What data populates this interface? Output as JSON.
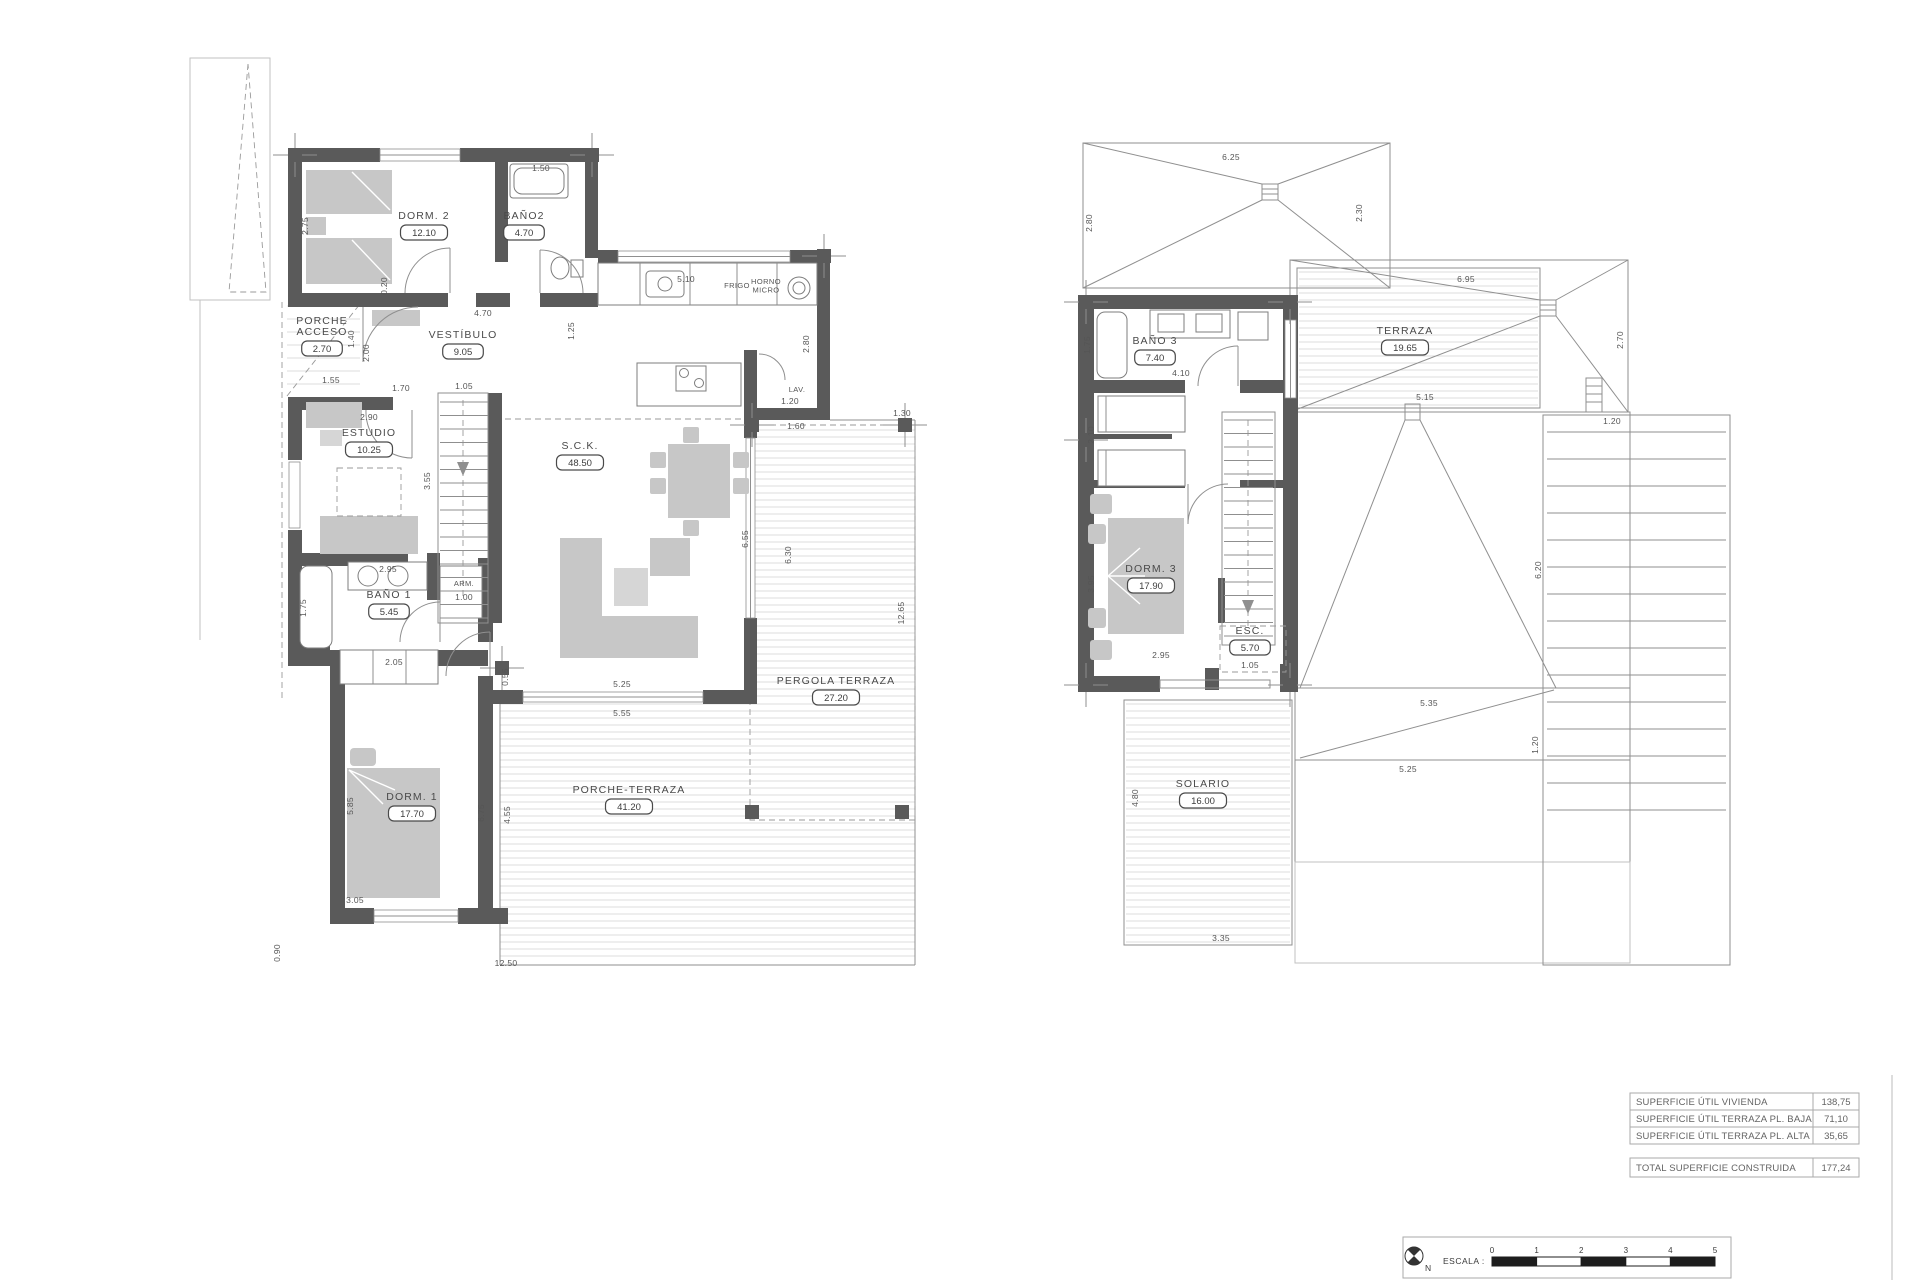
{
  "document": {
    "type": "architectural floor plan, two storeys"
  },
  "colors": {
    "wall": "#5a5a5a",
    "furniture": "#c7c7c7",
    "hatch": "#d2d2d2",
    "label": "#4a4a4a"
  },
  "ground_floor": {
    "rooms": [
      {
        "name": "DORM. 2",
        "area": "12.10",
        "x": 424,
        "y": 219
      },
      {
        "name": "BAÑO2",
        "area": "4.70",
        "x": 524,
        "y": 219
      },
      {
        "name": "PORCHE\nACCESO",
        "area": "2.70",
        "x": 322,
        "y": 324
      },
      {
        "name": "VESTÍBULO",
        "area": "9.05",
        "x": 463,
        "y": 338
      },
      {
        "name": "ESTUDIO",
        "area": "10.25",
        "x": 369,
        "y": 436
      },
      {
        "name": "S.C.K.",
        "area": "48.50",
        "x": 580,
        "y": 449
      },
      {
        "name": "BAÑO 1",
        "area": "5.45",
        "x": 389,
        "y": 598
      },
      {
        "name": "DORM. 1",
        "area": "17.70",
        "x": 412,
        "y": 800
      },
      {
        "name": "PERGOLA TERRAZA",
        "area": "27.20",
        "x": 836,
        "y": 684
      },
      {
        "name": "PORCHE-TERRAZA",
        "area": "41.20",
        "x": 629,
        "y": 793
      }
    ],
    "annotations": [
      {
        "text": "FRIGO",
        "x": 737,
        "y": 288
      },
      {
        "text": "HORNO\nMICRO",
        "x": 766,
        "y": 284
      },
      {
        "text": "LAV.",
        "x": 797,
        "y": 392
      },
      {
        "text": "ARM.",
        "x": 464,
        "y": 586
      }
    ],
    "dims": [
      {
        "t": "1.50",
        "x": 541,
        "y": 171,
        "r": 0
      },
      {
        "t": "2.75",
        "x": 308,
        "y": 226,
        "r": 90
      },
      {
        "t": "0.20",
        "x": 387,
        "y": 286,
        "r": 90
      },
      {
        "t": "4.70",
        "x": 483,
        "y": 316,
        "r": 0
      },
      {
        "t": "5.10",
        "x": 686,
        "y": 282,
        "r": 0
      },
      {
        "t": "1.25",
        "x": 574,
        "y": 331,
        "r": 90
      },
      {
        "t": "2.80",
        "x": 809,
        "y": 344,
        "r": 90
      },
      {
        "t": "1.20",
        "x": 790,
        "y": 404,
        "r": 0
      },
      {
        "t": "1.60",
        "x": 796,
        "y": 429,
        "r": 0
      },
      {
        "t": "1.30",
        "x": 902,
        "y": 416,
        "r": 0
      },
      {
        "t": "1.55",
        "x": 331,
        "y": 383,
        "r": 0
      },
      {
        "t": "1.70",
        "x": 401,
        "y": 391,
        "r": 0
      },
      {
        "t": "2.00",
        "x": 369,
        "y": 353,
        "r": 90
      },
      {
        "t": "1.40",
        "x": 354,
        "y": 339,
        "r": 90
      },
      {
        "t": "2.90",
        "x": 369,
        "y": 420,
        "r": 0
      },
      {
        "t": "1.05",
        "x": 464,
        "y": 389,
        "r": 0
      },
      {
        "t": "3.55",
        "x": 430,
        "y": 481,
        "r": 90
      },
      {
        "t": "2.95",
        "x": 388,
        "y": 572,
        "r": 0
      },
      {
        "t": "1.00",
        "x": 464,
        "y": 600,
        "r": 0
      },
      {
        "t": "1.75",
        "x": 306,
        "y": 608,
        "r": 90
      },
      {
        "t": "2.05",
        "x": 394,
        "y": 665,
        "r": 0
      },
      {
        "t": "0.55",
        "x": 508,
        "y": 677,
        "r": 90
      },
      {
        "t": "5.25",
        "x": 622,
        "y": 687,
        "r": 0
      },
      {
        "t": "5.55",
        "x": 622,
        "y": 716,
        "r": 0
      },
      {
        "t": "5.85",
        "x": 353,
        "y": 806,
        "r": 90
      },
      {
        "t": "6.75",
        "x": 484,
        "y": 813,
        "r": 90
      },
      {
        "t": "4.55",
        "x": 510,
        "y": 815,
        "r": 90
      },
      {
        "t": "3.05",
        "x": 355,
        "y": 903,
        "r": 0
      },
      {
        "t": "0.90",
        "x": 280,
        "y": 953,
        "r": 90
      },
      {
        "t": "12.50",
        "x": 506,
        "y": 966,
        "r": 0
      },
      {
        "t": "12.65",
        "x": 904,
        "y": 613,
        "r": 90
      },
      {
        "t": "6.55",
        "x": 748,
        "y": 539,
        "r": 90
      },
      {
        "t": "6.30",
        "x": 791,
        "y": 555,
        "r": 90
      }
    ]
  },
  "upper_floor": {
    "rooms": [
      {
        "name": "BAÑO 3",
        "area": "7.40",
        "x": 1155,
        "y": 344
      },
      {
        "name": "TERRAZA",
        "area": "19.65",
        "x": 1405,
        "y": 334
      },
      {
        "name": "DORM. 3",
        "area": "17.90",
        "x": 1151,
        "y": 572
      },
      {
        "name": "ESC.",
        "area": "5.70",
        "x": 1250,
        "y": 634
      },
      {
        "name": "SOLARIO",
        "area": "16.00",
        "x": 1203,
        "y": 787
      }
    ],
    "dims": [
      {
        "t": "6.25",
        "x": 1231,
        "y": 160,
        "r": 0
      },
      {
        "t": "2.80",
        "x": 1092,
        "y": 223,
        "r": 90
      },
      {
        "t": "2.30",
        "x": 1362,
        "y": 213,
        "r": 90
      },
      {
        "t": "6.95",
        "x": 1466,
        "y": 282,
        "r": 0
      },
      {
        "t": "2.70",
        "x": 1623,
        "y": 340,
        "r": 90
      },
      {
        "t": "1.20",
        "x": 1612,
        "y": 424,
        "r": 0
      },
      {
        "t": "5.15",
        "x": 1425,
        "y": 400,
        "r": 0
      },
      {
        "t": "6.20",
        "x": 1541,
        "y": 570,
        "r": 90
      },
      {
        "t": "5.35",
        "x": 1429,
        "y": 706,
        "r": 0
      },
      {
        "t": "5.25",
        "x": 1408,
        "y": 772,
        "r": 0
      },
      {
        "t": "1.20",
        "x": 1538,
        "y": 745,
        "r": 90
      },
      {
        "t": "1.75",
        "x": 1090,
        "y": 345,
        "r": 90
      },
      {
        "t": "4.10",
        "x": 1181,
        "y": 376,
        "r": 0
      },
      {
        "t": "2.10",
        "x": 1094,
        "y": 435,
        "r": 90
      },
      {
        "t": "3.95",
        "x": 1094,
        "y": 584,
        "r": 90
      },
      {
        "t": "2.95",
        "x": 1161,
        "y": 658,
        "r": 0
      },
      {
        "t": "1.05",
        "x": 1250,
        "y": 668,
        "r": 0
      },
      {
        "t": "4.80",
        "x": 1138,
        "y": 798,
        "r": 90
      },
      {
        "t": "3.35",
        "x": 1221,
        "y": 941,
        "r": 0
      }
    ]
  },
  "summary_table": {
    "rows": [
      {
        "label": "SUPERFICIE ÚTIL VIVIENDA",
        "value": "138,75"
      },
      {
        "label": "SUPERFICIE ÚTIL TERRAZA PL. BAJA",
        "value": "71,10"
      },
      {
        "label": "SUPERFICIE ÚTIL TERRAZA PL. ALTA",
        "value": "35,65"
      }
    ],
    "total": {
      "label": "TOTAL SUPERFICIE CONSTRUIDA",
      "value": "177,24"
    }
  },
  "scale_bar": {
    "label": "ESCALA :",
    "north": "N",
    "ticks": [
      "0",
      "1",
      "2",
      "3",
      "4",
      "5"
    ]
  }
}
